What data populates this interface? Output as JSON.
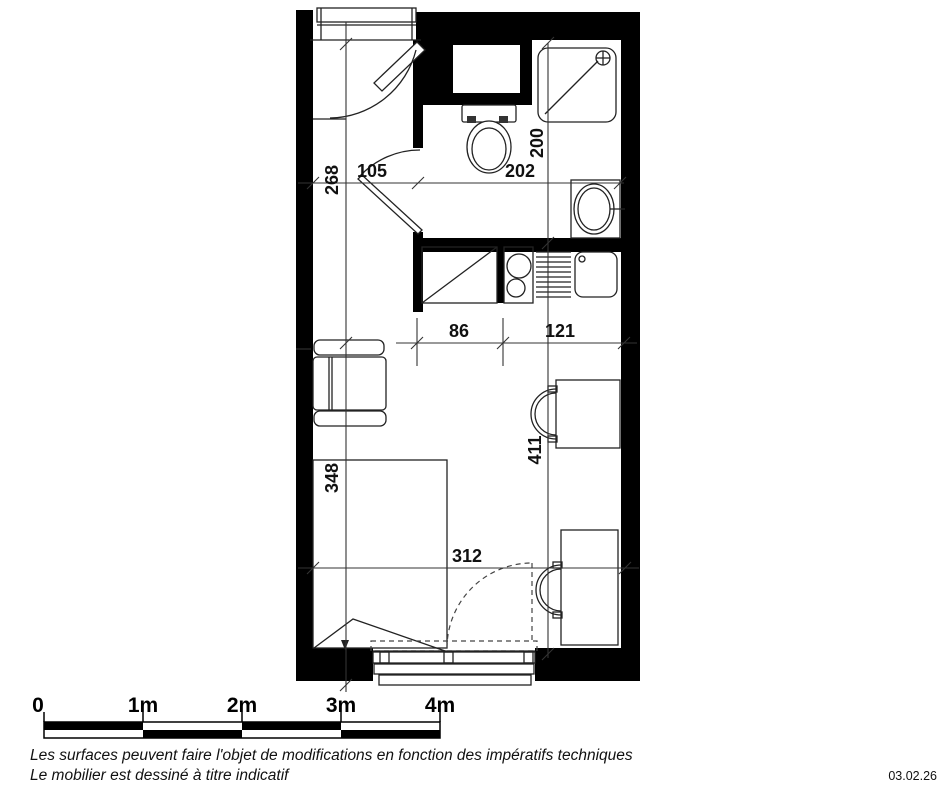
{
  "plan": {
    "type": "studio-apartment-floor-plan",
    "dimensions_cm": {
      "entry_width": "105",
      "bathroom_width": "202",
      "bathroom_depth": "200",
      "left_upper_depth": "268",
      "kitchen_width": "86",
      "kitchen_right": "121",
      "bed_wall_depth": "348",
      "room_depth": "411",
      "room_width": "312"
    },
    "fixtures": [
      "entry-door",
      "wardrobe",
      "toilet",
      "shower",
      "washbasin",
      "kitchenette-fridge",
      "kitchenette-hob",
      "kitchenette-sink",
      "armchair",
      "bed",
      "desk",
      "chair",
      "window"
    ],
    "colors": {
      "wall": "#000000",
      "line": "#222222",
      "background": "#ffffff"
    }
  },
  "scale_bar": {
    "labels": [
      "0",
      "1m",
      "2m",
      "3m",
      "4m"
    ]
  },
  "notes": {
    "line1": "Les surfaces peuvent faire l'objet de modifications en fonction des impératifs techniques",
    "line2": "Le mobilier est dessiné à titre indicatif"
  },
  "date": "03.02.26"
}
